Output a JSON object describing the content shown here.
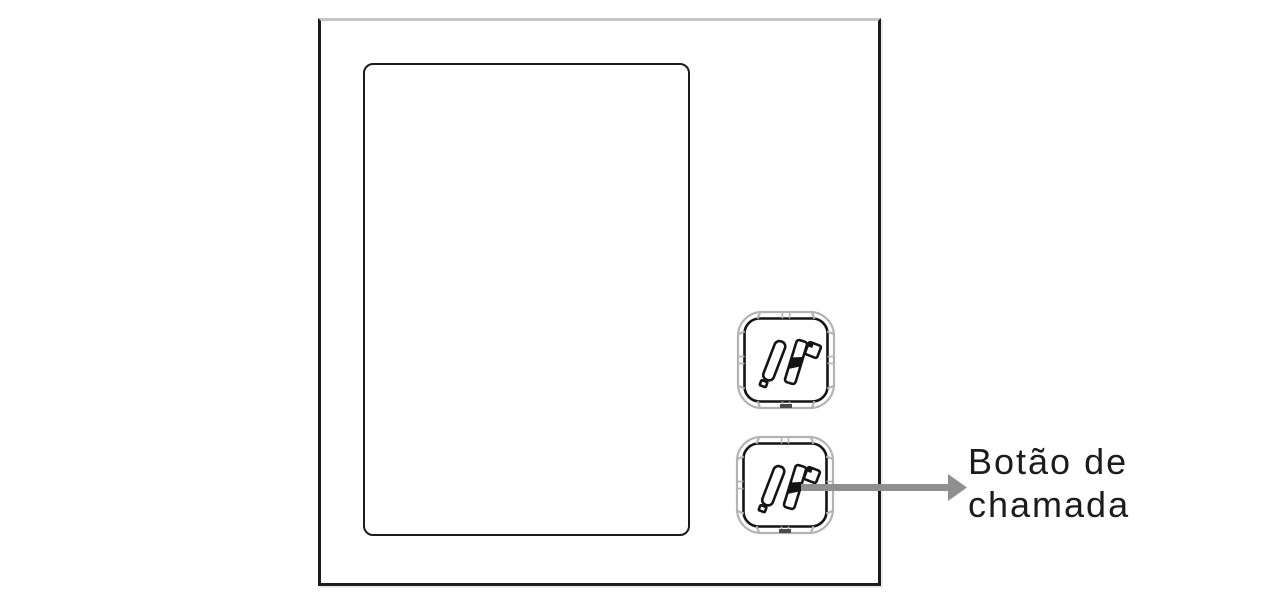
{
  "callout": {
    "label": "Botão de chamada",
    "label_line1": "Botão de",
    "label_line2": "chamada"
  },
  "buttons": {
    "top": {
      "icon": "finger-press-button-icon"
    },
    "bottom": {
      "icon": "finger-press-button-icon"
    }
  },
  "colors": {
    "background": "#ffffff",
    "panel_outline": "#1c1c1c",
    "panel_top_edge": "#c6c6c6",
    "screen_outline": "#1c1c1c",
    "button_ring": "#b3b3b3",
    "button_tab": "#4a4a4a",
    "icon_outline": "#141414",
    "arrow": "#8f8f8f",
    "text": "#1c1c1c"
  }
}
